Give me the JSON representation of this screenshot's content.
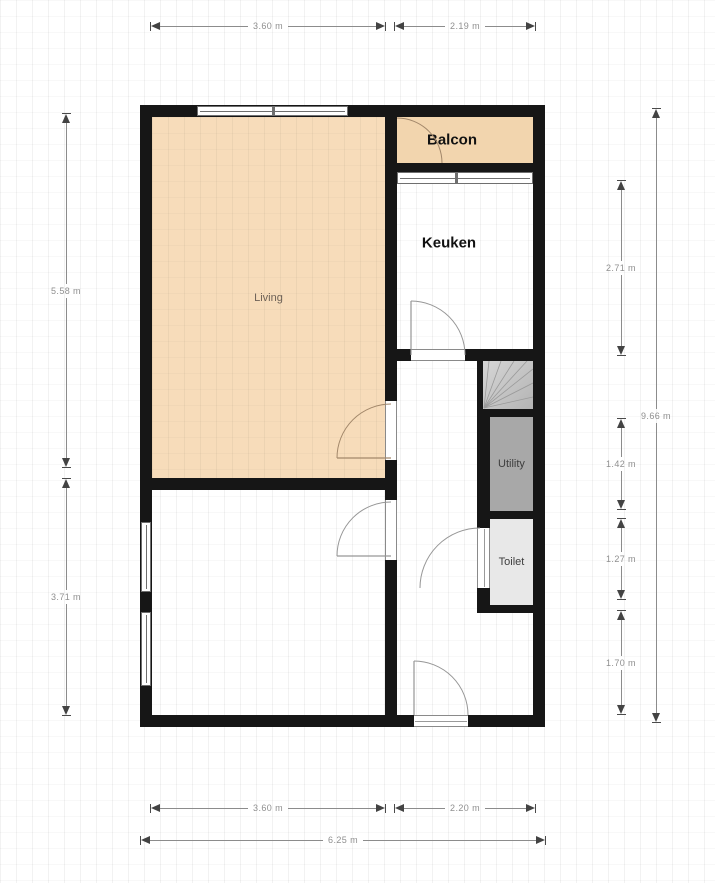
{
  "rooms": {
    "living": {
      "label": "Living"
    },
    "balcon": {
      "label": "Balcon"
    },
    "keuken": {
      "label": "Keuken"
    },
    "utility": {
      "label": "Utility"
    },
    "toilet": {
      "label": "Toilet"
    }
  },
  "dimensions": {
    "top_living_width": "3.60 m",
    "top_right_width": "2.19 m",
    "left_living_height": "5.58 m",
    "left_lower_height": "3.71 m",
    "right_keuken_height": "2.71 m",
    "right_utility_height": "1.42 m",
    "right_toilet_height": "1.27 m",
    "right_hall_height": "1.70 m",
    "right_total_height": "9.66 m",
    "bottom_left_width": "3.60 m",
    "bottom_right_width": "2.20 m",
    "bottom_total_width": "6.25 m"
  },
  "colors": {
    "wall": "#161616",
    "living_fill": "#f7dcba",
    "balcon_fill": "#f2d5ae",
    "utility_fill": "#a8a8a8",
    "toilet_fill": "#e8e8e8",
    "stairs_fill": "#c6c6c6",
    "dimension_text": "#8f8f8f"
  }
}
